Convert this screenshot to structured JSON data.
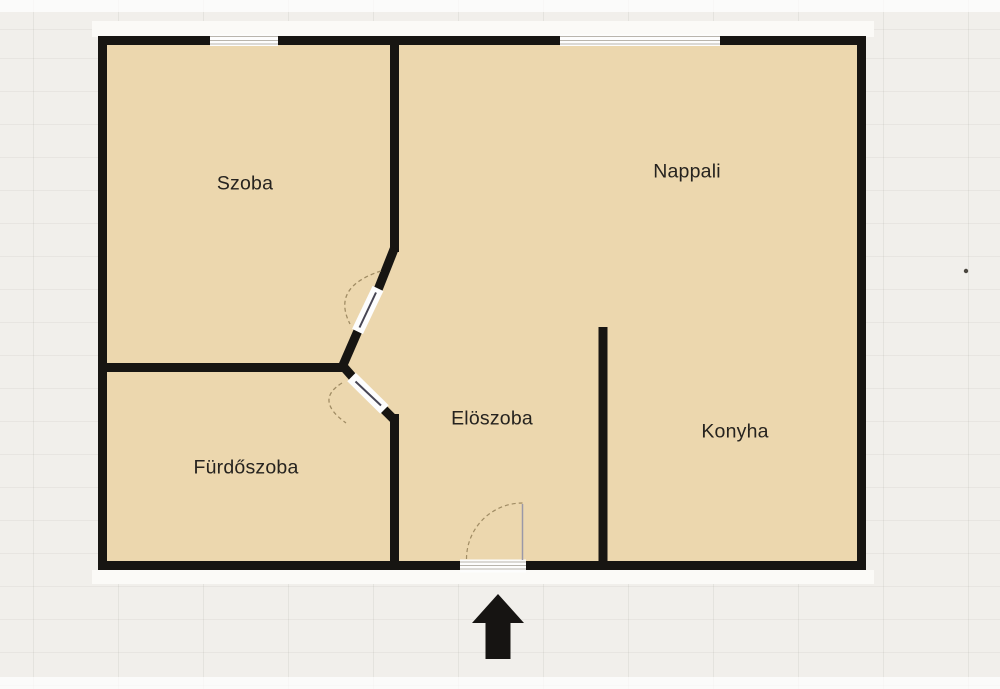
{
  "palette": {
    "background": "#f1efeb",
    "floor": "#ecd7ae",
    "wall": "#171512",
    "label_text": "#26231f",
    "door_arc": "#a08c64",
    "window_line": "#b9b5ad",
    "arrow": "#161412"
  },
  "plan": {
    "rooms": [
      {
        "id": "szoba",
        "label": "Szoba"
      },
      {
        "id": "nappali",
        "label": "Nappali"
      },
      {
        "id": "eloszoba",
        "label": "Elöszoba"
      },
      {
        "id": "furdoszoba",
        "label": "Fürdőszoba"
      },
      {
        "id": "konyha",
        "label": "Konyha"
      }
    ],
    "entrance": {
      "icon": "up-arrow"
    }
  }
}
